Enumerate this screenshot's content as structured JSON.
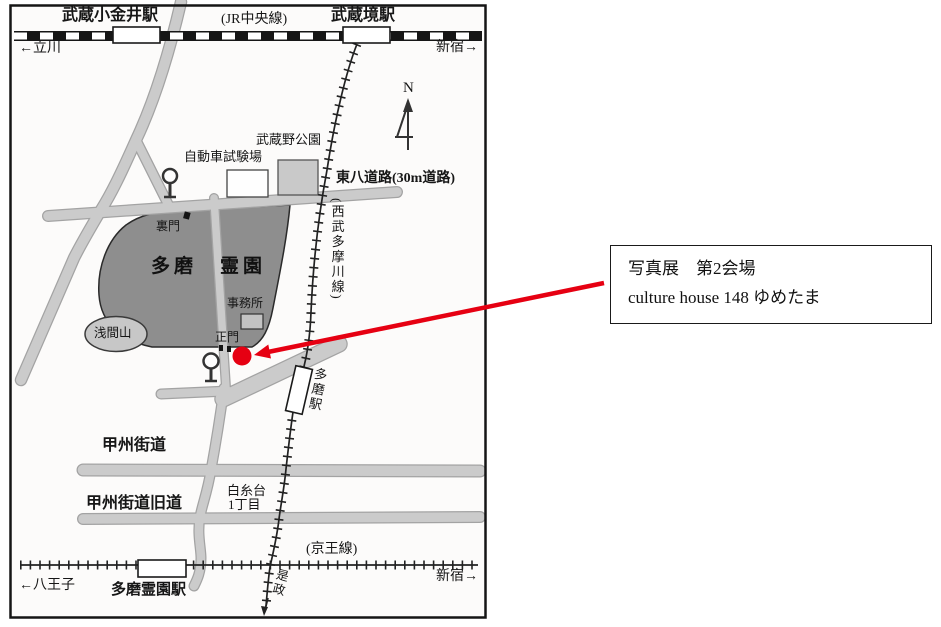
{
  "callout": {
    "line1": "写真展　第2会場",
    "line2": "culture house 148 ゆめたま"
  },
  "jr": {
    "station_left": "武蔵小金井駅",
    "line_name": "(JR中央線)",
    "station_right": "武蔵境駅",
    "dir_left": "←立川",
    "dir_right": "新宿→"
  },
  "compass": {
    "label": "N"
  },
  "mid": {
    "park": "武蔵野公園",
    "test_center": "自動車試験場",
    "tohachi": "東八道路(30m道路)",
    "seibu": "(西武多摩川線)",
    "back_gate": "裏門",
    "cemetery": "多磨　霊園",
    "office": "事務所",
    "sengen": "浅間山",
    "main_gate": "正門",
    "tama_station": "多磨駅"
  },
  "south": {
    "koshu": "甲州街道",
    "koshu_old": "甲州街道旧道",
    "shiraito_l1": "白糸台",
    "shiraito_l2": "1丁目",
    "keio": "(京王線)",
    "dir_left": "←八王子",
    "station": "多磨霊園駅",
    "dir_right": "新宿→",
    "koremasa": "是政"
  },
  "colors": {
    "accent_red": "#e60012",
    "road_gray": "#cbcbcb",
    "road_edge_gray": "#a3a3a3",
    "cemetery_gray": "#8e8e8e",
    "hill_gray": "#c7c7c7",
    "rail_black": "#1a1a1a"
  },
  "icons": {
    "traffic_signal": "circle-on-pole",
    "compass": "north-arrow",
    "venue_marker": "red-dot",
    "callout_pointer": "red-arrow"
  }
}
